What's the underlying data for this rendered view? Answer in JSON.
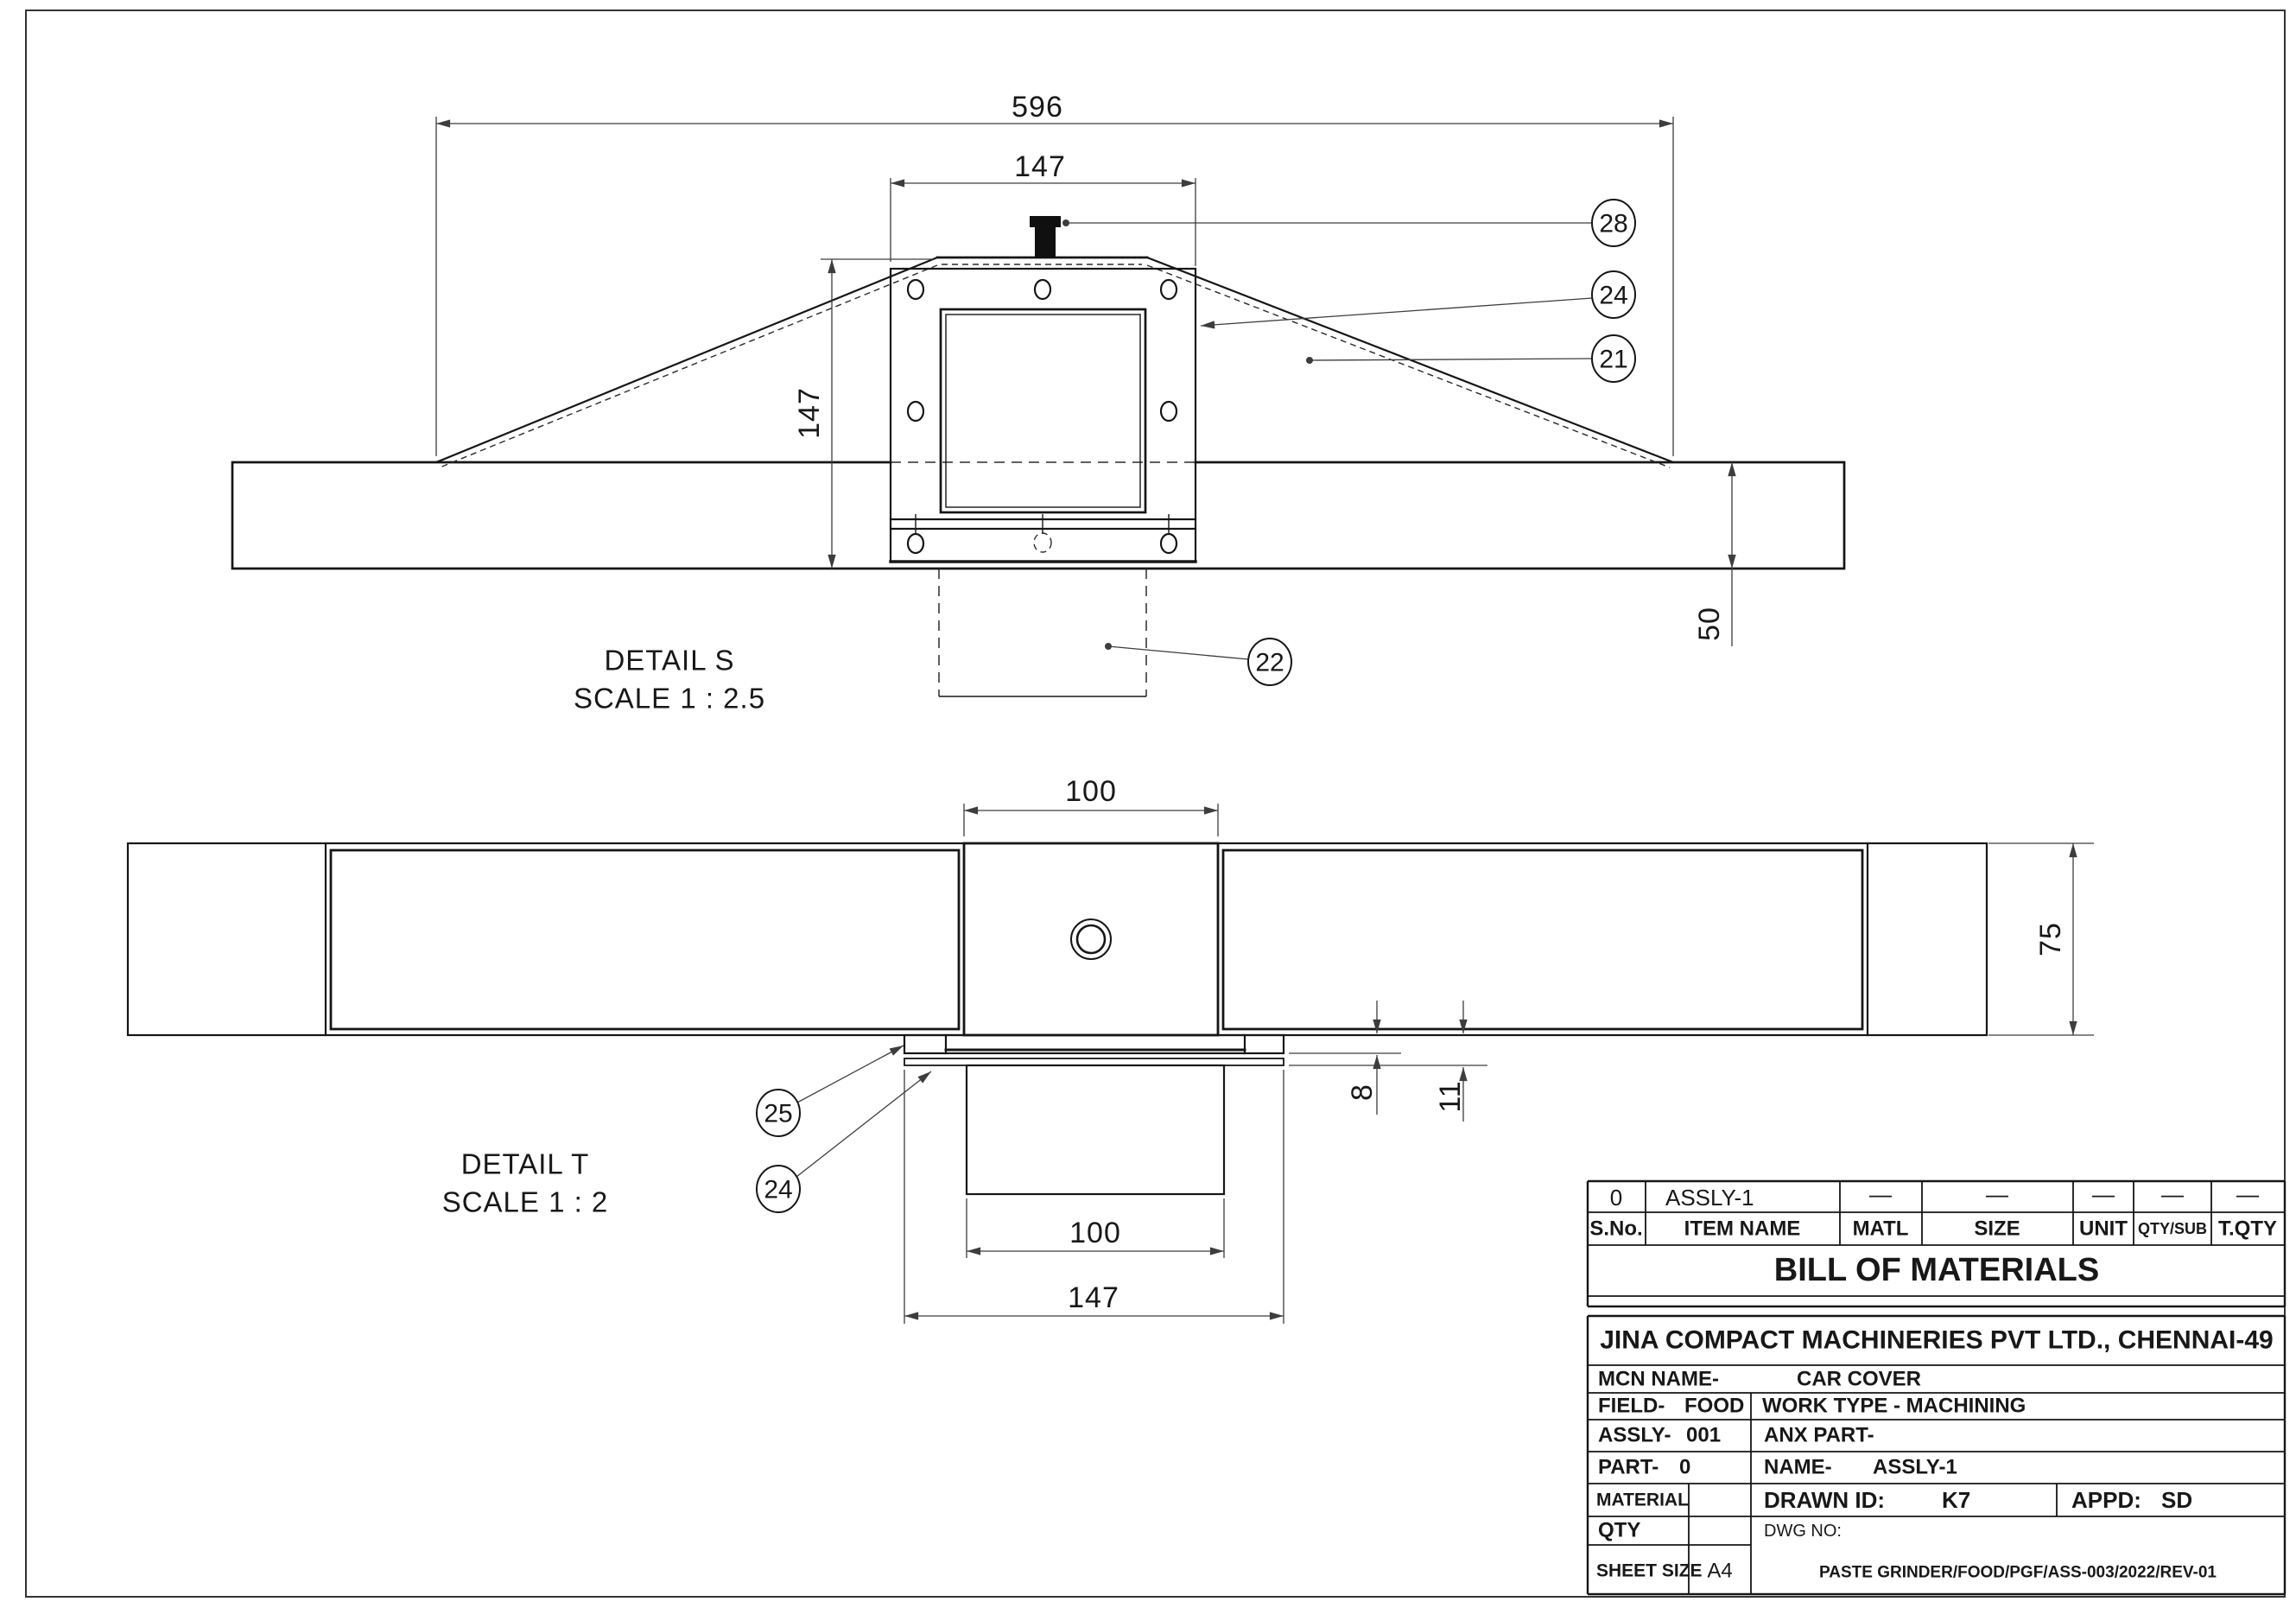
{
  "views": {
    "detail_s": {
      "title": "DETAIL S",
      "scale": "SCALE 1 : 2.5",
      "dim_overall": "596",
      "dim_top_width": "147",
      "dim_height": "147",
      "dim_base": "50",
      "balloon_28": "28",
      "balloon_24": "24",
      "balloon_21": "21",
      "balloon_22": "22"
    },
    "detail_t": {
      "title": "DETAIL T",
      "scale": "SCALE 1 : 2",
      "dim_square": "100",
      "dim_height": "75",
      "dim_8": "8",
      "dim_11": "11",
      "dim_lower": "100",
      "dim_flange": "147",
      "balloon_25": "25",
      "balloon_24": "24"
    }
  },
  "bom": {
    "title": "BILL OF MATERIALS",
    "columns": [
      {
        "header": "S.No.",
        "value": "0"
      },
      {
        "header": "ITEM NAME",
        "value": "ASSLY-1"
      },
      {
        "header": "MATL",
        "value": "—"
      },
      {
        "header": "SIZE",
        "value": "—"
      },
      {
        "header": "UNIT",
        "value": "—"
      },
      {
        "header": "QTY/SUB",
        "value": "—"
      },
      {
        "header": "T.QTY",
        "value": "—"
      }
    ]
  },
  "title_block": {
    "company": "JINA COMPACT MACHINERIES PVT LTD., CHENNAI-49",
    "mcn_label": "MCN NAME-",
    "mcn_value": "CAR COVER",
    "field_label": "FIELD-",
    "field_value": "FOOD",
    "work_type": "WORK TYPE - MACHINING",
    "assly_label": "ASSLY-",
    "assly_value": "001",
    "anx_label": "ANX PART-",
    "part_label": "PART-",
    "part_value": "0",
    "name_label": "NAME-",
    "name_value": "ASSLY-1",
    "material_label": "MATERIAL",
    "drawn_label": "DRAWN ID:",
    "drawn_value": "K7",
    "appd_label": "APPD:",
    "appd_value": "SD",
    "qty_label": "QTY",
    "dwg_label": "DWG NO:",
    "dwg_number": "PASTE GRINDER/FOOD/PGF/ASS-003/2022/REV-01",
    "sheet_label": "SHEET SIZE",
    "sheet_value": "A4"
  }
}
